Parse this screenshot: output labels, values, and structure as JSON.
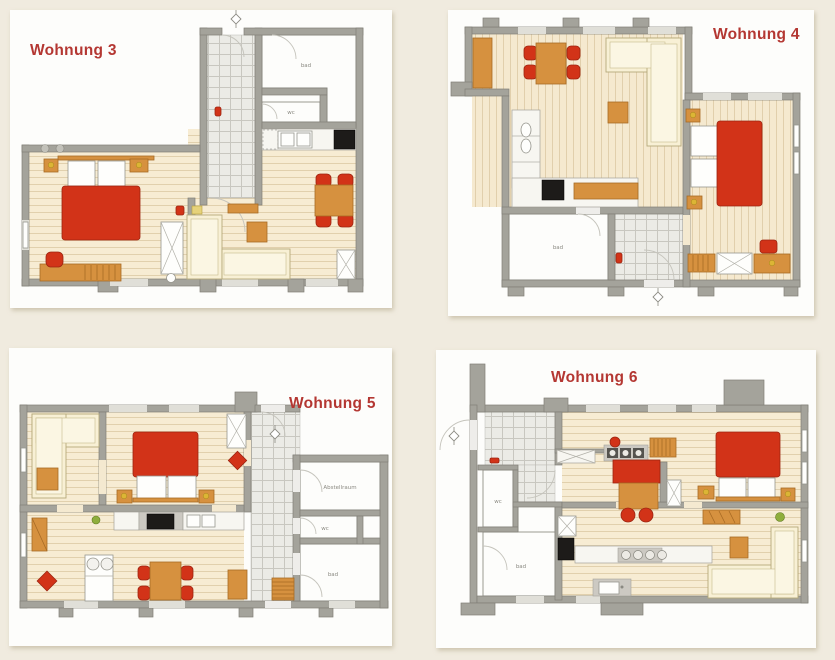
{
  "page": {
    "background": "#f0ebdf"
  },
  "palette": {
    "page_bg": "#f0ebdf",
    "card_bg": "#fdfdfb",
    "wall": "#a4a39b",
    "wall_dark": "#807f77",
    "wood_floor": "#f7ecd3",
    "wood_line": "#dcc9a4",
    "tile_floor": "#ebebe6",
    "tile_line": "#c8c7c0",
    "furniture_red": "#d23318",
    "furniture_wood": "#d6913f",
    "sofa_cream": "#f8f0d5",
    "appliance_black": "#1d1b19",
    "label_red": "#b43732",
    "room_label": "#8b8a82"
  },
  "plans": [
    {
      "id": "wohnung-3",
      "title": "Wohnung 3",
      "rooms": [
        {
          "label": "bad"
        },
        {
          "label": "wc"
        }
      ]
    },
    {
      "id": "wohnung-4",
      "title": "Wohnung 4",
      "rooms": [
        {
          "label": "bad"
        }
      ]
    },
    {
      "id": "wohnung-5",
      "title": "Wohnung 5",
      "rooms": [
        {
          "label": "Abstellraum"
        },
        {
          "label": "wc"
        },
        {
          "label": "bad"
        }
      ]
    },
    {
      "id": "wohnung-6",
      "title": "Wohnung 6",
      "rooms": [
        {
          "label": "wc"
        },
        {
          "label": "bad"
        }
      ]
    }
  ]
}
